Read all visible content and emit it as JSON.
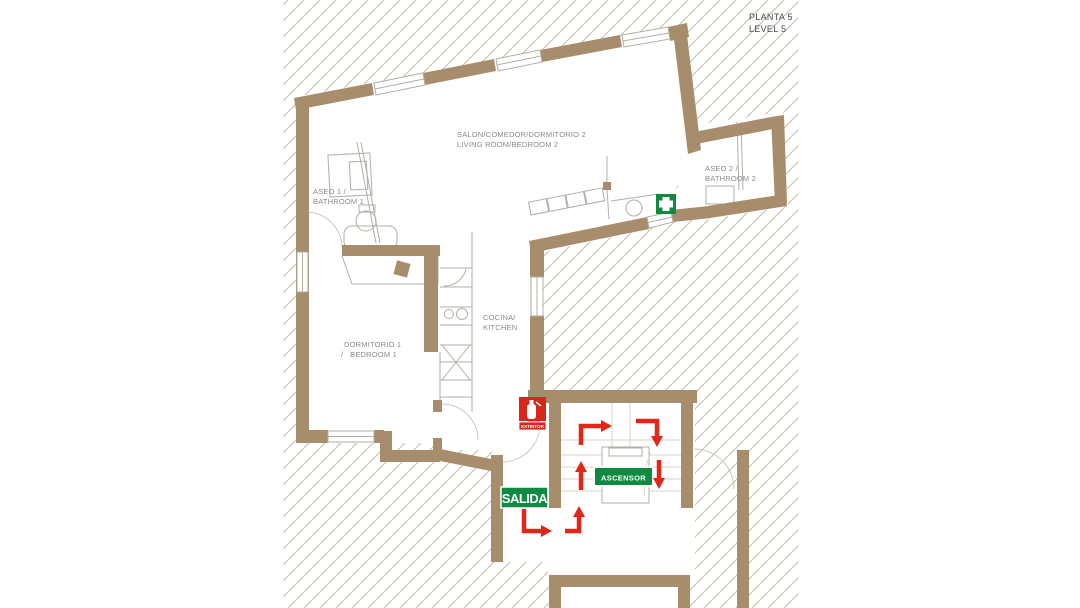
{
  "plan": {
    "title_line1": "PLANTA 5",
    "title_line2": "LEVEL 5"
  },
  "rooms": {
    "salon_line1": "SALON/COMEDOR/DORMITORIO 2",
    "salon_line2": "LIVING ROOM/BEDROOM 2",
    "aseo1_line1": "ASEO 1 /",
    "aseo1_line2": "BATHROOM 1",
    "aseo2_line1": "ASEO 2 /",
    "aseo2_line2": "BATHROOM 2",
    "cocina_line1": "COCINA/",
    "cocina_line2": "KITCHEN",
    "dorm1_line1": "DORMITORIO 1",
    "dorm1_line2": "/   BEDROOM 1"
  },
  "signs": {
    "exit": "SALIDA",
    "elevator": "ASCENSOR",
    "extinguisher": "EXTINTOR"
  },
  "colors": {
    "wall": "#a78d6c",
    "hatch": "#cfc6b5",
    "line": "#b0b0a7",
    "label": "#8a8a8a",
    "title": "#4c4c4c",
    "sign-green": "#0f8a41",
    "sign-red": "#d3281a",
    "arrow-red": "#e02718"
  }
}
